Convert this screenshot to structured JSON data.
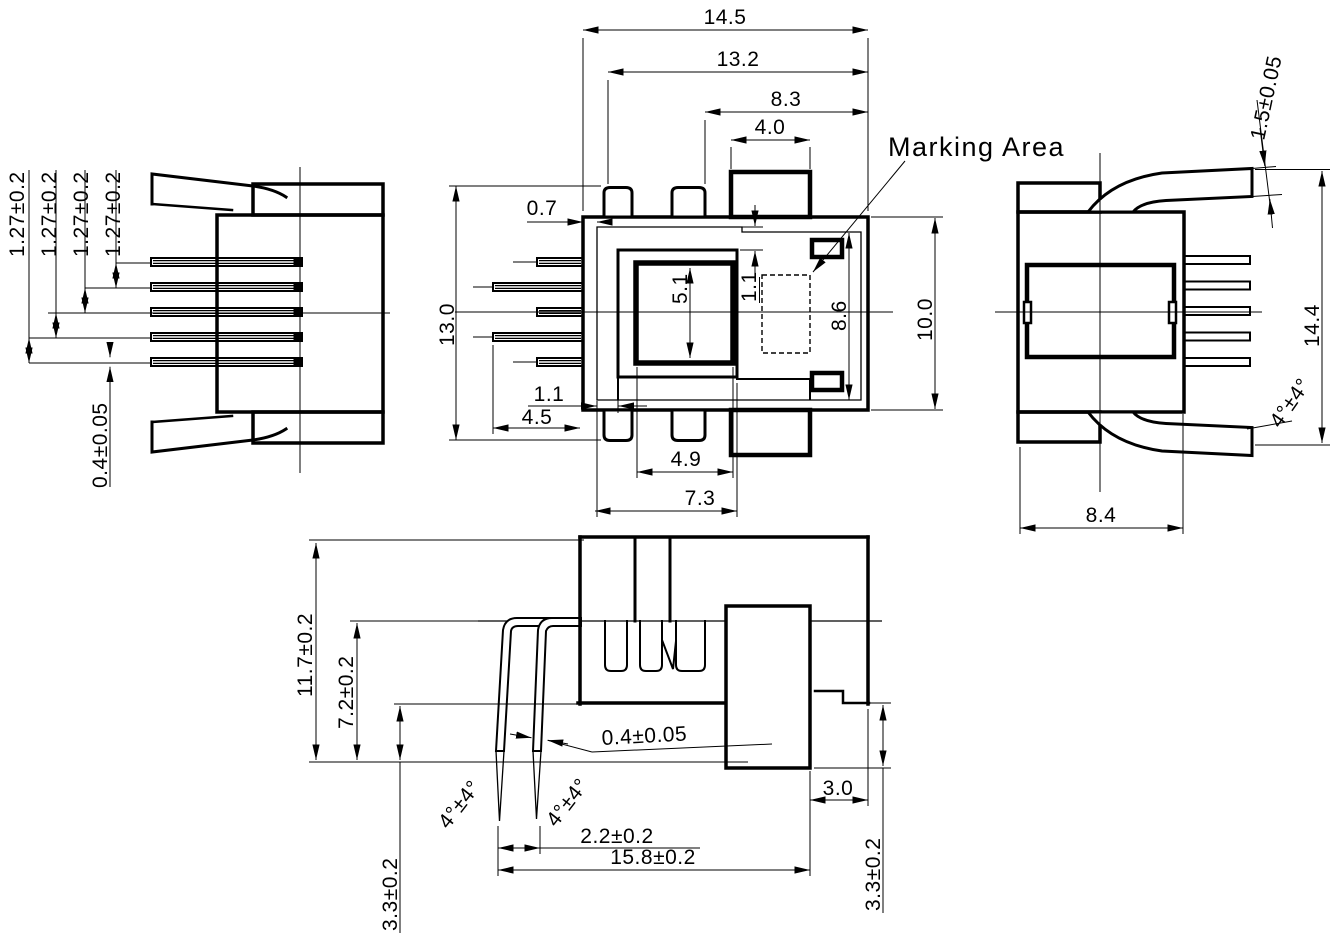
{
  "marking_area_label": "Marking Area",
  "front_view": {
    "width_total": "14.5",
    "width_inner": "13.2",
    "width_right": "8.3",
    "tab_width": "4.0",
    "height_total": "13.0",
    "shell_gap": "0.7",
    "cavity_height": "5.1",
    "offset_top": "1.1",
    "opening_height": "8.6",
    "body_height": "10.0",
    "offset_bottom": "1.1",
    "pin_length": "4.5",
    "cavity_width": "4.9",
    "housing_width": "7.3"
  },
  "left_view": {
    "pin_pitch": [
      "1.27±0.2",
      "1.27±0.2",
      "1.27±0.2",
      "1.27±0.2"
    ],
    "pin_thickness": "0.4±0.05"
  },
  "right_view": {
    "leg_thickness": "1.5±0.05",
    "height_total": "14.4",
    "leg_angle": "4°±4°",
    "depth": "8.4"
  },
  "bottom_view": {
    "height_total": "11.7±0.2",
    "height_above_board": "7.2±0.2",
    "pin_thickness": "0.4±0.05",
    "pin_angle_left": "4°±4°",
    "pin_angle_right": "4°±4°",
    "pin_tip_spacing": "2.2±0.2",
    "length_total": "15.8±0.2",
    "boss_offset": "3.0",
    "standoff_left": "3.3±0.2",
    "standoff_right": "3.3±0.2"
  }
}
